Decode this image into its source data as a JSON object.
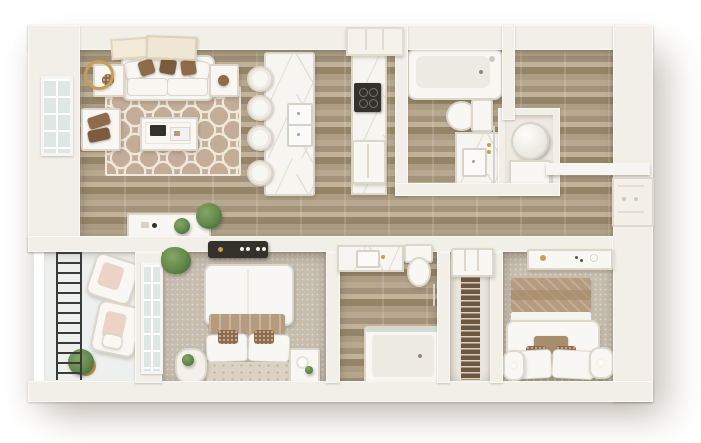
{
  "meta": {
    "title": "3D top-down dollhouse rendering of a two-bedroom, two-bathroom apartment floor plan with balcony",
    "render_style": "photorealistic overhead 3D render, neutral white and beige palette on a plain white background",
    "text_on_screen": "none"
  },
  "colors": {
    "wall": "#f2efe9",
    "wallEdge": "#ddd6cb",
    "wood1": "#b7a98f",
    "wood2": "#a2937a",
    "wood3": "#c1b39a",
    "wood4": "#948568",
    "wood5": "#ac9d84",
    "woodSeam": "rgba(252,250,244,0.14)",
    "carpet": "#c6bdaf",
    "carpetDot": "rgba(255,255,255,0.35)",
    "rug": "#c3ad99",
    "rugLine": "#f0e8da",
    "marble": "#f7f5f1",
    "marbleVein": "#d8d4cb",
    "furn": "#f9f7f3",
    "furnEdge": "#dcd6cb",
    "furnShade": "#eeeae2",
    "dark": "#34302a",
    "brown": "#8f6b4a",
    "brown2": "#7c5b3e",
    "tan": "#b69c7e",
    "tan2": "#a78d6e",
    "green": "#61874a",
    "green2": "#3f6434",
    "blush": "#ecd3c5",
    "gold": "#c79e54",
    "glass": "#dfe7e5",
    "balconyFloor": "#eef0ef",
    "railing": "#3a3a38",
    "tubInner": "#edeae3",
    "closetFloor": "#efebe3",
    "clothes": "#6e5740",
    "clothesLine": "#d9d1c2",
    "rug2": "#a69a86",
    "headboard": "#dcd2c3",
    "shadow": "rgba(130,118,100,0.40)"
  },
  "rooms": {
    "living": {
      "label": "Living room (hardwood floor)"
    },
    "kitchen": {
      "label": "Kitchen (hardwood floor)"
    },
    "bathroom_1": {
      "label": "Bathroom 1 with tub, toilet and vanity"
    },
    "utility_closet": {
      "label": "Utility closet with water heater"
    },
    "flex_room": {
      "label": "Dining / flex room (hardwood floor)"
    },
    "hallway": {
      "label": "Hallway"
    },
    "balcony": {
      "label": "Balcony with railing and lounge chairs"
    },
    "bedroom_1": {
      "label": "Bedroom 1 (carpet)"
    },
    "bathroom_2": {
      "label": "Bathroom 2 with vanity, toilet and tub"
    },
    "walk_in_closet": {
      "label": "Walk-in closet"
    },
    "bedroom_2": {
      "label": "Bedroom 2 (carpet)"
    }
  },
  "furniture": {
    "sofa": "white sofa with brown accent pillows",
    "art": "two framed artworks leaning on wall",
    "armchair": "white armchair with brown cushions",
    "coffee_table": "white coffee table with books",
    "side_table_left": "side table with round gold mirror",
    "side_table_right": "side table with decor",
    "rug": "tan quatrefoil-pattern area rug",
    "console": "white console table with green plants",
    "plant_large": "potted green plant",
    "island": "marble kitchen island with double sink",
    "stool": "white bar stool",
    "counter": "marble counter run",
    "cooktop": "black cooktop",
    "fridge": "refrigerator",
    "cabinets": "upper kitchen cabinets",
    "tub1": "bathtub with shower fixture",
    "toilet1": "toilet",
    "vanity1": "marble vanity with gold faucet",
    "water_heater": "cylindrical water heater",
    "utility_unit": "utility unit",
    "shelf": "wall-mounted shelf",
    "panel": "wall-mounted panel",
    "railing": "black metal balcony railing",
    "lounge_chair": "lounge chair with blush cushion",
    "topiary": "green topiary ball in gold pot",
    "french_door": "glazed french door to balcony",
    "window": "window in left wall",
    "tv_console": "dark wall media console",
    "bed1": "bed with white duvet, tan throw and tufted footboard",
    "basket": "woven basket with greenery",
    "nightstand": "white nightstand with flowers",
    "plant_bedroom": "green potted plant",
    "vanity2": "marble vanity with square sink",
    "toilet2": "toilet",
    "tub2": "bathtub with glass panel",
    "towel_bar": "towel bar",
    "closet_shelves": "closet shelf unit",
    "clothes_rod": "clothes hanging on closet rod",
    "dresser": "white dresser with decor objects",
    "bed2": "bed with tan blanket and white pillows",
    "rug_bed2": "woven bedside rug",
    "pouf_lamp": "round bedside pouf with lamp"
  }
}
